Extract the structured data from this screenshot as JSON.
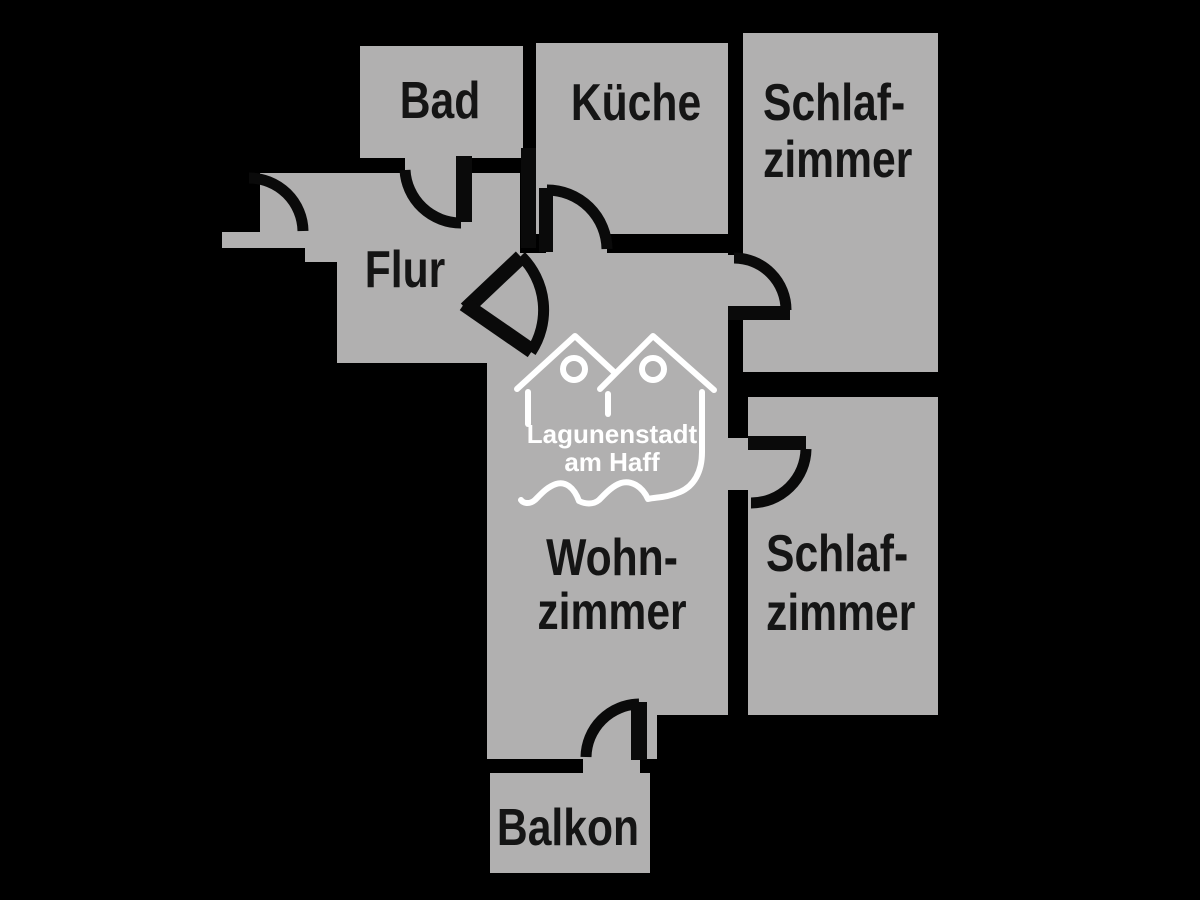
{
  "plan": {
    "rooms": {
      "bad": {
        "label": "Bad"
      },
      "kueche": {
        "label": "Küche"
      },
      "schlafzimmer_top": {
        "label_line1": "Schlaf-",
        "label_line2": "zimmer"
      },
      "flur": {
        "label": "Flur"
      },
      "wohnzimmer": {
        "label_line1": "Wohn-",
        "label_line2": "zimmer"
      },
      "schlafzimmer_bottom": {
        "label_line1": "Schlaf-",
        "label_line2": "zimmer"
      },
      "balkon": {
        "label": "Balkon"
      }
    },
    "logo": {
      "line1": "Lagunenstadt",
      "line2": "am Haff"
    },
    "colors": {
      "background": "#000000",
      "room_fill": "#b1b0b0",
      "wall": "#000000",
      "label_text": "#151515",
      "logo": "#ffffff"
    }
  }
}
